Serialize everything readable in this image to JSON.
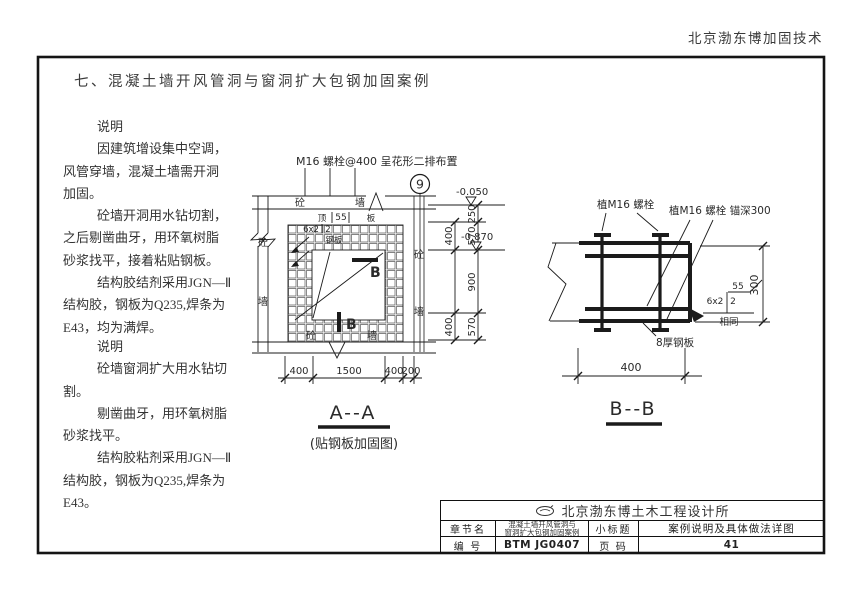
{
  "header": {
    "brand": "北京渤东博加固技术"
  },
  "page_title": "七、混凝土墙开风管洞与窗洞扩大包钢加固案例",
  "notes_block1": {
    "lines": [
      "说明",
      "因建筑增设集中空调，",
      "风管穿墙，混凝土墙需开洞",
      "加固。",
      "砼墙开洞用水钻切割，",
      "之后剔凿曲牙，用环氧树脂",
      "砂浆找平，接着粘贴钢板。",
      "结构胶结剂采用JGN—Ⅱ",
      "结构胶，钢板为Q235,焊条为",
      "E43，均为满焊。"
    ]
  },
  "notes_block2": {
    "lines": [
      "说明",
      "砼墙窗洞扩大用水钻切",
      "割。",
      "剔凿曲牙，用环氧树脂",
      "砂浆找平。",
      "结构胶粘剂采用JGN—Ⅱ",
      "结构胶，钢板为Q235,焊条为",
      "E43。"
    ]
  },
  "fig_a": {
    "top_note": "M16 螺栓@400 呈花形二排布置",
    "axis_no": "9",
    "band_left": "砼",
    "band_right": "墙",
    "slab_left": "顶",
    "slab_dim": "55",
    "slab_right": "板",
    "weld_size": "6x2",
    "weld_n": "2",
    "plate": "钢板",
    "wall_left_top": "砼",
    "wall_left_bot": "墙",
    "wall_right_top": "砼",
    "wall_right_bot": "墙",
    "wall_bot_left": "砼",
    "wall_bot_right": "墙",
    "section_b": "B",
    "level_top": "-0.050",
    "level_mid": "-0.870",
    "dim_inner_top": "400",
    "dim_inner_bot": "400",
    "dims_outer": [
      "250",
      "570",
      "900",
      "570"
    ],
    "dims_bottom": [
      "400",
      "1500",
      "400",
      "200"
    ],
    "caption": "A--A",
    "subcaption": "(贴钢板加固图)"
  },
  "fig_b": {
    "bolt_label": "植M16 螺栓",
    "anchor_label": "植M16 螺栓 锚深300",
    "weld_top": "55",
    "weld_size": "6x2",
    "weld_n": "2",
    "weld_same": "相同",
    "dim_side": "300",
    "plate_label": "8厚钢板",
    "dim_bottom": "400",
    "caption": "B--B"
  },
  "title_block": {
    "company": "北京渤东博土木工程设计所",
    "r2c1": "章节名",
    "r2c2_line1": "混凝土墙开风管洞与",
    "r2c2_line2": "窗洞扩大包钢加固案例",
    "r2c3": "小标题",
    "r2c4": "案例说明及具体做法详图",
    "r3c1": "编 号",
    "r3c2": "BTM JG0407",
    "r3c3": "页 码",
    "r3c4": "41"
  }
}
